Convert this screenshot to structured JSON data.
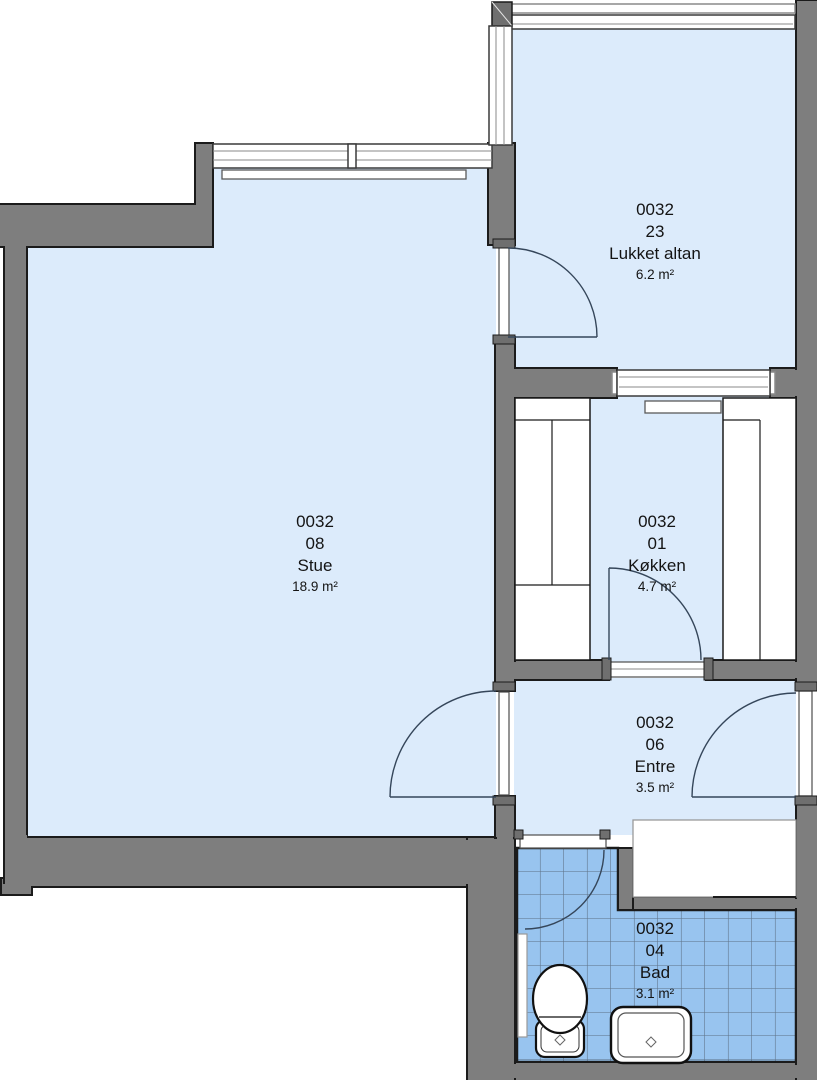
{
  "plan": {
    "title": "Apartment floor plan 0032",
    "rooms": [
      {
        "key": "lukket-altan",
        "apartment": "0032",
        "room_no": "23",
        "name": "Lukket altan",
        "area": "6.2 m²"
      },
      {
        "key": "stue",
        "apartment": "0032",
        "room_no": "08",
        "name": "Stue",
        "area": "18.9 m²"
      },
      {
        "key": "kokken",
        "apartment": "0032",
        "room_no": "01",
        "name": "Køkken",
        "area": "4.7 m²"
      },
      {
        "key": "entre",
        "apartment": "0032",
        "room_no": "06",
        "name": "Entre",
        "area": "3.5 m²"
      },
      {
        "key": "bad",
        "apartment": "0032",
        "room_no": "04",
        "name": "Bad",
        "area": "3.1 m²"
      }
    ],
    "colors": {
      "wall": "#7e7e7e",
      "outline": "#1b1b1b",
      "room_fill": "#dcebfb",
      "tile_fill": "#98c4ef",
      "tile_line": "#5d7186",
      "arc": "#35465a",
      "label": "#141414"
    },
    "fixtures": [
      "toilet",
      "sink",
      "bath-radiator",
      "wardrobe",
      "kitchen-counter-left",
      "kitchen-counter-right",
      "stue-radiator"
    ]
  }
}
